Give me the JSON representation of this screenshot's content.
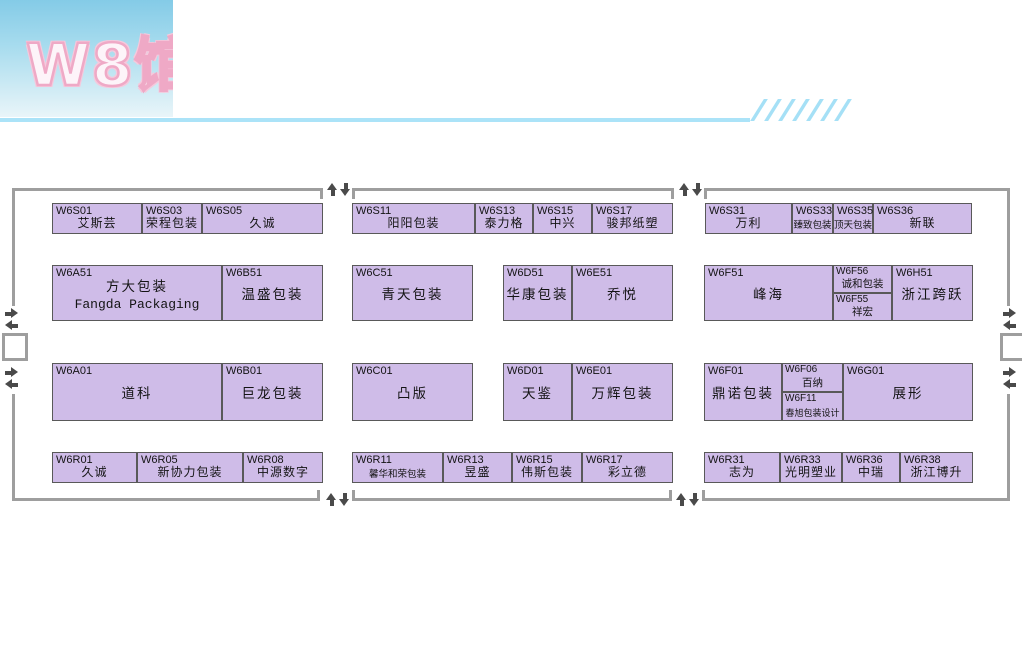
{
  "header": {
    "title": "W8馆",
    "title_pink": "#efa9c6",
    "gradient_top": "#84cbe7",
    "gradient_bottom": "#e9f5f9",
    "line_color": "#abe3f8",
    "slash_count": 7
  },
  "hall": {
    "wall_color": "#9e9e9e",
    "booth_fill": "#cfbce8",
    "booth_border": "#595959"
  },
  "booths": {
    "w6s01": {
      "code": "W6S01",
      "name": "艾斯芸"
    },
    "w6s03": {
      "code": "W6S03",
      "name": "荣程包装"
    },
    "w6s05": {
      "code": "W6S05",
      "name": "久诚"
    },
    "w6s11": {
      "code": "W6S11",
      "name": "阳阳包装"
    },
    "w6s13": {
      "code": "W6S13",
      "name": "泰力格"
    },
    "w6s15": {
      "code": "W6S15",
      "name": "中兴"
    },
    "w6s17": {
      "code": "W6S17",
      "name": "骏邦纸塑"
    },
    "w6s31": {
      "code": "W6S31",
      "name": "万利"
    },
    "w6s33": {
      "code": "W6S33",
      "name": "臻致包装"
    },
    "w6s35": {
      "code": "W6S35",
      "name": "顶天包装"
    },
    "w6s36": {
      "code": "W6S36",
      "name": "新联"
    },
    "w6a51": {
      "code": "W6A51",
      "name": "方大包装",
      "name_en": "Fangda Packaging"
    },
    "w6b51": {
      "code": "W6B51",
      "name": "温盛包装"
    },
    "w6c51": {
      "code": "W6C51",
      "name": "青天包装"
    },
    "w6d51": {
      "code": "W6D51",
      "name": "华康包装"
    },
    "w6e51": {
      "code": "W6E51",
      "name": "乔悦"
    },
    "w6f51": {
      "code": "W6F51",
      "name": "峰海"
    },
    "w6f56": {
      "code": "W6F56",
      "name": "诚和包装"
    },
    "w6f55": {
      "code": "W6F55",
      "name": "祥宏"
    },
    "w6h51": {
      "code": "W6H51",
      "name": "浙江跨跃"
    },
    "w6a01": {
      "code": "W6A01",
      "name": "道科"
    },
    "w6b01": {
      "code": "W6B01",
      "name": "巨龙包装"
    },
    "w6c01": {
      "code": "W6C01",
      "name": "凸版"
    },
    "w6d01": {
      "code": "W6D01",
      "name": "天鉴"
    },
    "w6e01": {
      "code": "W6E01",
      "name": "万辉包装"
    },
    "w6f01": {
      "code": "W6F01",
      "name": "鼎诺包装"
    },
    "w6f06": {
      "code": "W6F06",
      "name": "百纳"
    },
    "w6f11": {
      "code": "W6F11",
      "name": "春旭包装设计"
    },
    "w6g01": {
      "code": "W6G01",
      "name": "展形"
    },
    "w6r01": {
      "code": "W6R01",
      "name": "久诚"
    },
    "w6r05": {
      "code": "W6R05",
      "name": "新协力包装"
    },
    "w6r08": {
      "code": "W6R08",
      "name": "中源数字"
    },
    "w6r11": {
      "code": "W6R11",
      "name": "馨华和荣包装"
    },
    "w6r13": {
      "code": "W6R13",
      "name": "昱盛"
    },
    "w6r15": {
      "code": "W6R15",
      "name": "伟斯包装"
    },
    "w6r17": {
      "code": "W6R17",
      "name": "彩立德"
    },
    "w6r31": {
      "code": "W6R31",
      "name": "志为"
    },
    "w6r33": {
      "code": "W6R33",
      "name": "光明塑业"
    },
    "w6r36": {
      "code": "W6R36",
      "name": "中瑞"
    },
    "w6r38": {
      "code": "W6R38",
      "name": "浙江博升"
    }
  }
}
